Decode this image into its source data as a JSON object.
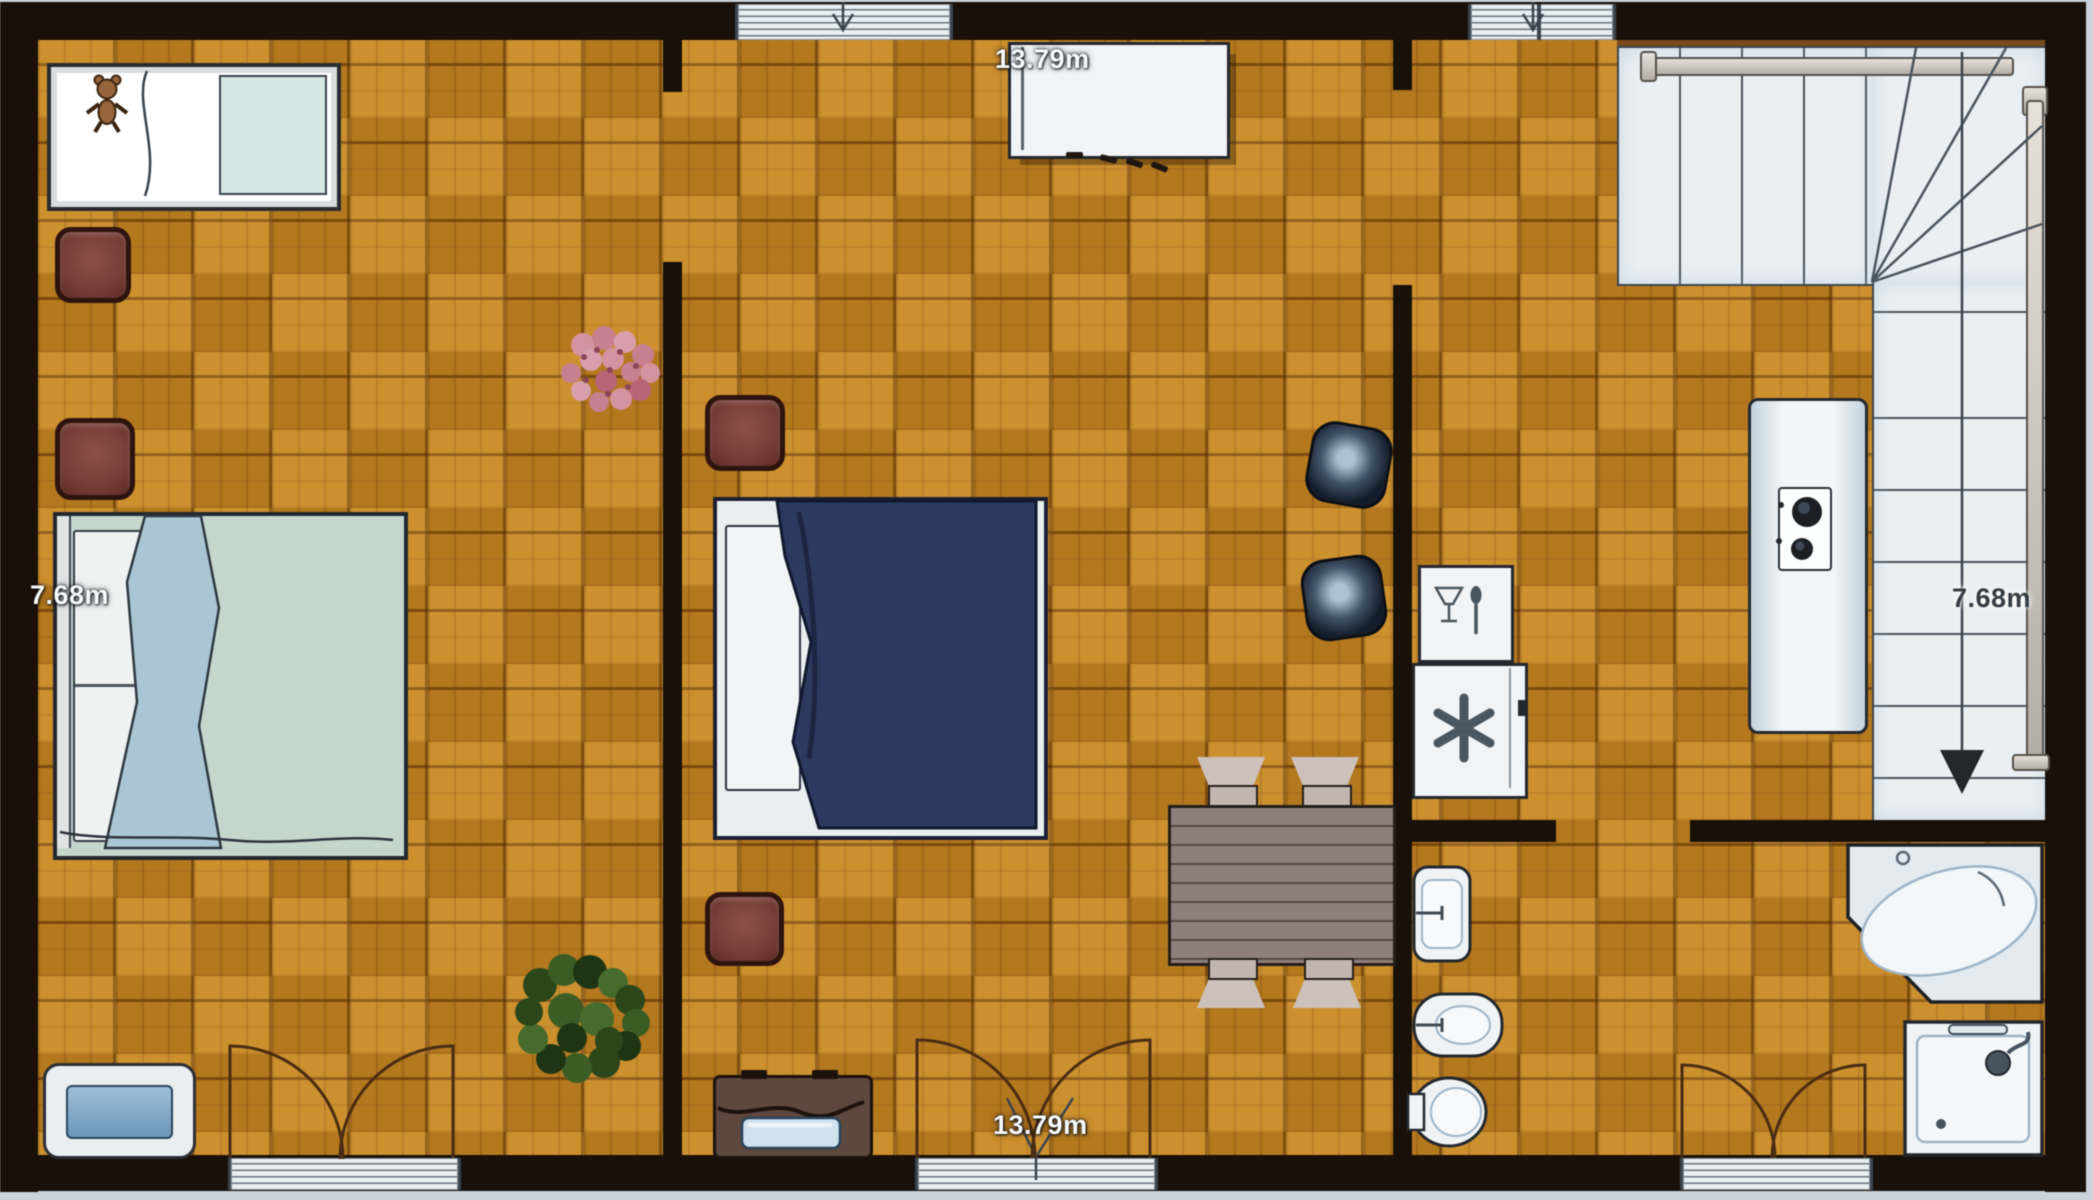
{
  "floor_plan": {
    "view": "top-down-apartment-floor-plan",
    "dimension_labels": {
      "top": "13.79m",
      "bottom": "13.79m",
      "left": "7.68m",
      "right": "7.68m"
    },
    "icons": {
      "dishwasher": "wine-glass-and-spoon-icon",
      "freezer": "snowflake-asterisk-icon",
      "cooktop": "two-burner-hob-icon",
      "stairs_direction": "down-arrow-icon",
      "doors": "quarter-circle-swing-arcs"
    },
    "colors": {
      "wall": "#191009",
      "floor_parquet": "#c8861f",
      "outside": "#c9d3d9",
      "stairs": "#e9eff3",
      "single_bed_cover": "#d4e6e2",
      "double_bed_left_cover": "#c3d7cd",
      "double_bed_middle_cover": "#2d3a61",
      "stool": "#7a4038",
      "dining_table": "#8d7f7a",
      "lounge_chair": "#131c2a",
      "fixtures_white": "#eef3f6",
      "door_arc": "#4a2c12",
      "flowers": "#d693a1",
      "plant": "#3a5c24"
    },
    "furniture": [
      "single-bed-with-teddy-bear",
      "nightstand-stool",
      "nightstand-stool",
      "double-bed-left",
      "pet-bed",
      "flower-bouquet",
      "nightstand-stool",
      "double-bed-middle",
      "nightstand-stool",
      "green-plant",
      "suitcase",
      "sideboard",
      "dining-table",
      "dining-chair",
      "dining-chair",
      "dining-chair",
      "dining-chair",
      "lounge-chair",
      "lounge-chair",
      "dishwasher",
      "freezer",
      "kitchen-counter-with-cooktop",
      "staircase",
      "wash-basin",
      "bidet",
      "toilet",
      "corner-bathtub",
      "shower"
    ]
  }
}
